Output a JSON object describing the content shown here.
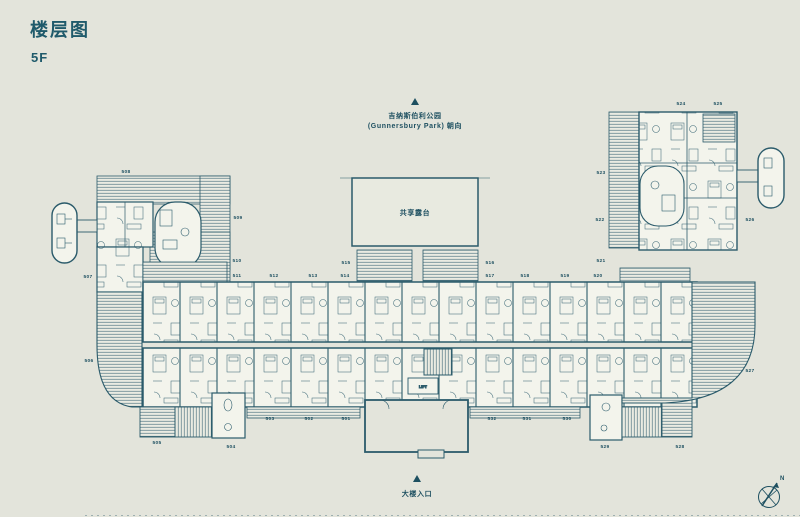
{
  "page": {
    "title": "楼层图",
    "floor": "5F"
  },
  "orientation_top": {
    "line1": "吉纳斯伯利公园",
    "line2": "(Gunnersbury Park) 朝向"
  },
  "shared_terrace": {
    "label": "共享露台"
  },
  "entrance": {
    "label": "大楼入口"
  },
  "core": {
    "lift_label": "LIFT"
  },
  "compass": {
    "north_label": "N"
  },
  "colors": {
    "background": "#e3e4db",
    "wall_line": "#2b5b6b",
    "text": "#1d4f60",
    "room_fill": "#f3f4ec",
    "hatch_fill": "#eaebe2"
  },
  "units": [
    {
      "id": "501",
      "x": 346,
      "y": 420
    },
    {
      "id": "502",
      "x": 309,
      "y": 420
    },
    {
      "id": "503",
      "x": 270,
      "y": 420
    },
    {
      "id": "504",
      "x": 231,
      "y": 448
    },
    {
      "id": "505",
      "x": 157,
      "y": 444
    },
    {
      "id": "506",
      "x": 89,
      "y": 362
    },
    {
      "id": "507",
      "x": 88,
      "y": 278
    },
    {
      "id": "508",
      "x": 126,
      "y": 173
    },
    {
      "id": "509",
      "x": 238,
      "y": 219
    },
    {
      "id": "510",
      "x": 237,
      "y": 262
    },
    {
      "id": "511",
      "x": 237,
      "y": 277
    },
    {
      "id": "512",
      "x": 274,
      "y": 277
    },
    {
      "id": "513",
      "x": 313,
      "y": 277
    },
    {
      "id": "514",
      "x": 345,
      "y": 277
    },
    {
      "id": "515",
      "x": 346,
      "y": 264
    },
    {
      "id": "516",
      "x": 490,
      "y": 264
    },
    {
      "id": "517",
      "x": 490,
      "y": 277
    },
    {
      "id": "518",
      "x": 525,
      "y": 277
    },
    {
      "id": "519",
      "x": 565,
      "y": 277
    },
    {
      "id": "520",
      "x": 598,
      "y": 277
    },
    {
      "id": "521",
      "x": 601,
      "y": 262
    },
    {
      "id": "522",
      "x": 600,
      "y": 221
    },
    {
      "id": "523",
      "x": 601,
      "y": 174
    },
    {
      "id": "524",
      "x": 681,
      "y": 105
    },
    {
      "id": "525",
      "x": 718,
      "y": 105
    },
    {
      "id": "526",
      "x": 750,
      "y": 221
    },
    {
      "id": "527",
      "x": 750,
      "y": 372
    },
    {
      "id": "528",
      "x": 680,
      "y": 448
    },
    {
      "id": "529",
      "x": 605,
      "y": 448
    },
    {
      "id": "530",
      "x": 567,
      "y": 420
    },
    {
      "id": "531",
      "x": 527,
      "y": 420
    },
    {
      "id": "532",
      "x": 492,
      "y": 420
    }
  ]
}
